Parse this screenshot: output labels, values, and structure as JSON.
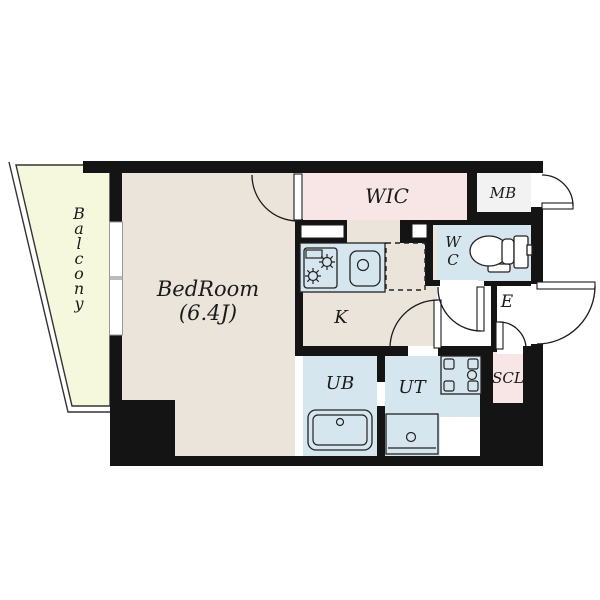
{
  "title": "apartment-floor-plan",
  "colors": {
    "wall": "#141414",
    "floor_beige": "#EAE4DA",
    "wet_area_blue": "#D6E6EF",
    "closet_pink": "#F8E6E6",
    "balcony_green": "#F5F8DC",
    "mail_box_gray": "#F2F2F2",
    "hall_white": "#FFFFFF"
  },
  "rooms": {
    "balcony": {
      "label": "Balcony",
      "letters": [
        "B",
        "a",
        "l",
        "c",
        "o",
        "n",
        "y"
      ]
    },
    "bedroom": {
      "name": "BedRoom",
      "size": "(6.4J)"
    },
    "wic": {
      "label": "WIC"
    },
    "mb": {
      "label": "MB"
    },
    "wc": {
      "line1": "W",
      "line2": "C"
    },
    "entrance": {
      "label": "E"
    },
    "scl": {
      "label": "SCL"
    },
    "kitchen": {
      "label": "K"
    },
    "ub": {
      "label": "UB"
    },
    "ut": {
      "label": "UT"
    }
  },
  "fixtures": [
    "stove-burners",
    "kitchen-sink",
    "refrigerator-space",
    "toilet",
    "bathtub",
    "washer-pan",
    "washbasin",
    "sliding-window"
  ]
}
